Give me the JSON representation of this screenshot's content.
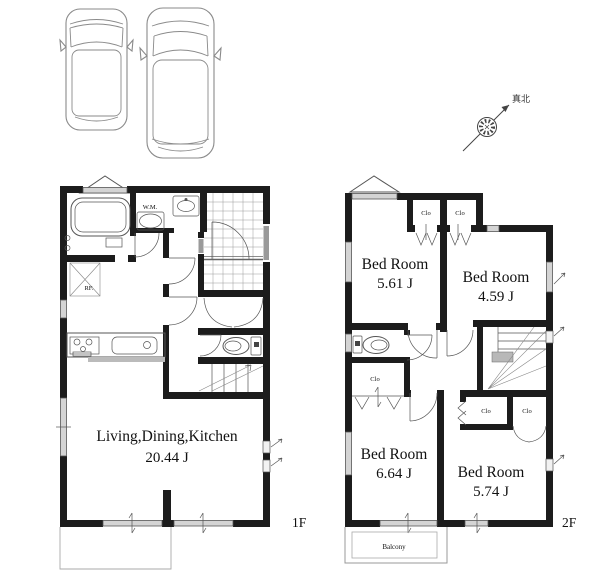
{
  "compass": {
    "label": "真北"
  },
  "colors": {
    "wall": "#1c1c1c",
    "window_gray": "#d4d4d4",
    "line": "#555555",
    "background": "#ffffff"
  },
  "floor1": {
    "label": "1F",
    "room": {
      "name": "Living,Dining,Kitchen",
      "area": "20.44 J"
    },
    "labels": {
      "wm": "W.M.",
      "rf": "RF."
    }
  },
  "floor2": {
    "label": "2F",
    "bedrooms": [
      {
        "name": "Bed Room",
        "area": "5.61 J"
      },
      {
        "name": "Bed Room",
        "area": "4.59 J"
      },
      {
        "name": "Bed Room",
        "area": "6.64 J"
      },
      {
        "name": "Bed Room",
        "area": "5.74 J"
      }
    ],
    "closet_label": "Clo",
    "balcony_label": "Balcony"
  }
}
